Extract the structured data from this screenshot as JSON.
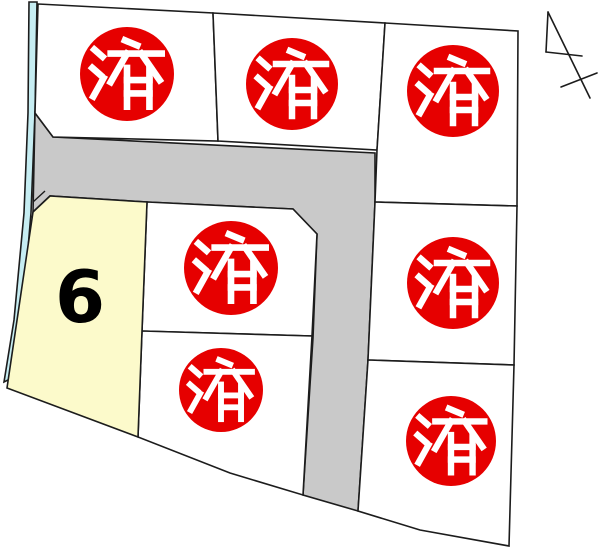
{
  "map": {
    "kind": "residential-lot-map",
    "sold_label": "済",
    "available_lot_number": "6"
  },
  "lots": [
    {
      "position": "top-left",
      "status": "sold",
      "label": "済"
    },
    {
      "position": "top-middle",
      "status": "sold",
      "label": "済"
    },
    {
      "position": "top-right",
      "status": "sold",
      "label": "済"
    },
    {
      "position": "right-middle",
      "status": "sold",
      "label": "済"
    },
    {
      "position": "right-bottom",
      "status": "sold",
      "label": "済"
    },
    {
      "position": "center-upper",
      "status": "sold",
      "label": "済"
    },
    {
      "position": "center-lower",
      "status": "sold",
      "label": "済"
    },
    {
      "position": "west",
      "status": "available",
      "label": "6"
    }
  ],
  "icons": {
    "north_arrow": "north-arrow"
  },
  "colors": {
    "sold_badge_fill": "#e60000",
    "sold_badge_text": "#ffffff",
    "sold_lot_fill": "#ffffff",
    "available_lot_fill": "#fcfacb",
    "road_fill": "#c9c9c9",
    "waterway_fill": "#c6edf2",
    "boundary_stroke": "#1c1c1c",
    "lot_number_text": "#000000",
    "background": "#ffffff"
  }
}
